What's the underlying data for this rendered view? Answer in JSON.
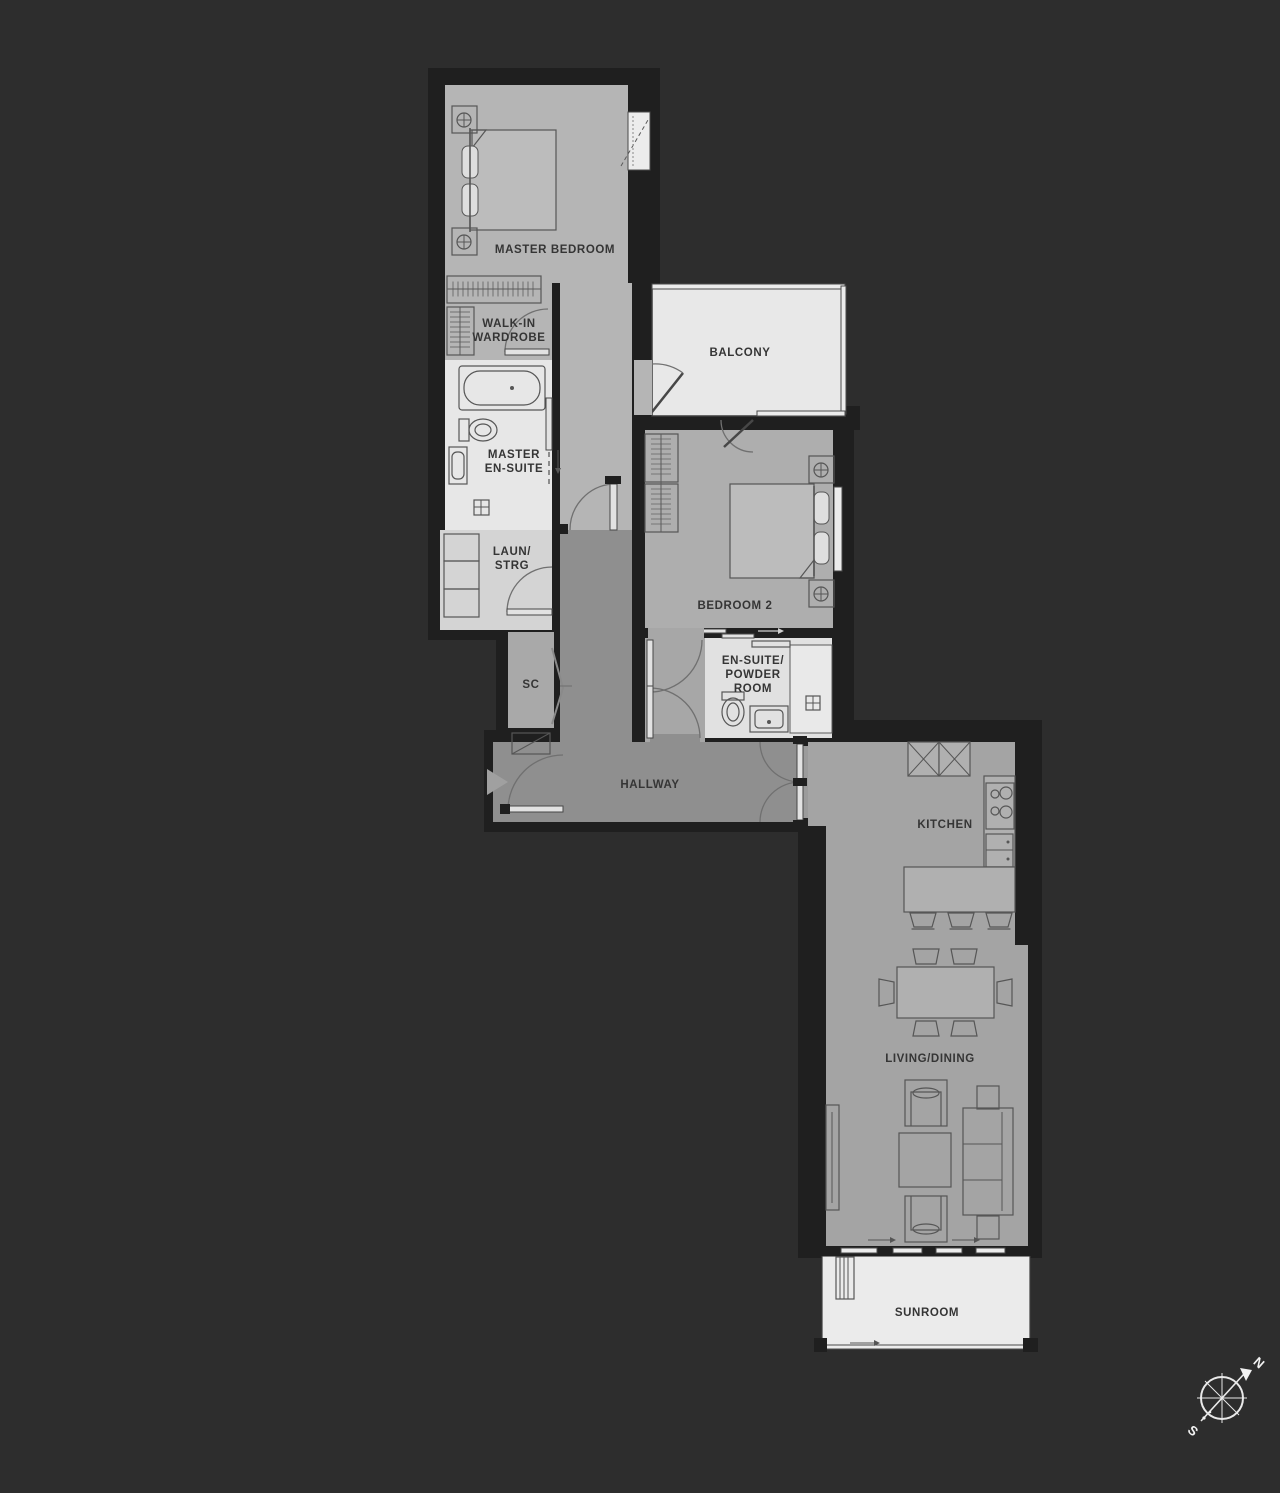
{
  "rooms": {
    "master_bedroom": {
      "label": "MASTER BEDROOM"
    },
    "walk_in_wardrobe": {
      "lines": [
        "WALK-IN",
        "WARDROBE"
      ]
    },
    "master_en_suite": {
      "lines": [
        "MASTER",
        "EN-SUITE"
      ]
    },
    "laun_strg": {
      "lines": [
        "LAUN/",
        "STRG"
      ]
    },
    "sc": {
      "label": "SC"
    },
    "balcony": {
      "label": "BALCONY"
    },
    "bedroom_2": {
      "label": "BEDROOM 2"
    },
    "en_suite_powder_room": {
      "lines": [
        "EN-SUITE/",
        "POWDER",
        "ROOM"
      ]
    },
    "hallway": {
      "label": "HALLWAY"
    },
    "kitchen": {
      "label": "KITCHEN"
    },
    "living_dining": {
      "label": "LIVING/DINING"
    },
    "sunroom": {
      "label": "SUNROOM"
    }
  },
  "compass": {
    "north_label": "N",
    "south_label": "S"
  },
  "colors": {
    "background": "#2d2d2d",
    "wall": "#1f1f1f",
    "floor_master_suite": "#b5b5b5",
    "floor_bathroom": "#e7e7e7",
    "floor_laundry": "#d4d4d4",
    "floor_hallway": "#8f8f8f",
    "floor_bedroom2": "#aeaeae",
    "floor_kitchen_living": "#a4a4a4",
    "floor_balcony": "#e8e8e8",
    "floor_sunroom": "#ebebeb",
    "furniture_line": "#565656",
    "label_text": "#353535",
    "compass_line": "#e9e9e9"
  }
}
